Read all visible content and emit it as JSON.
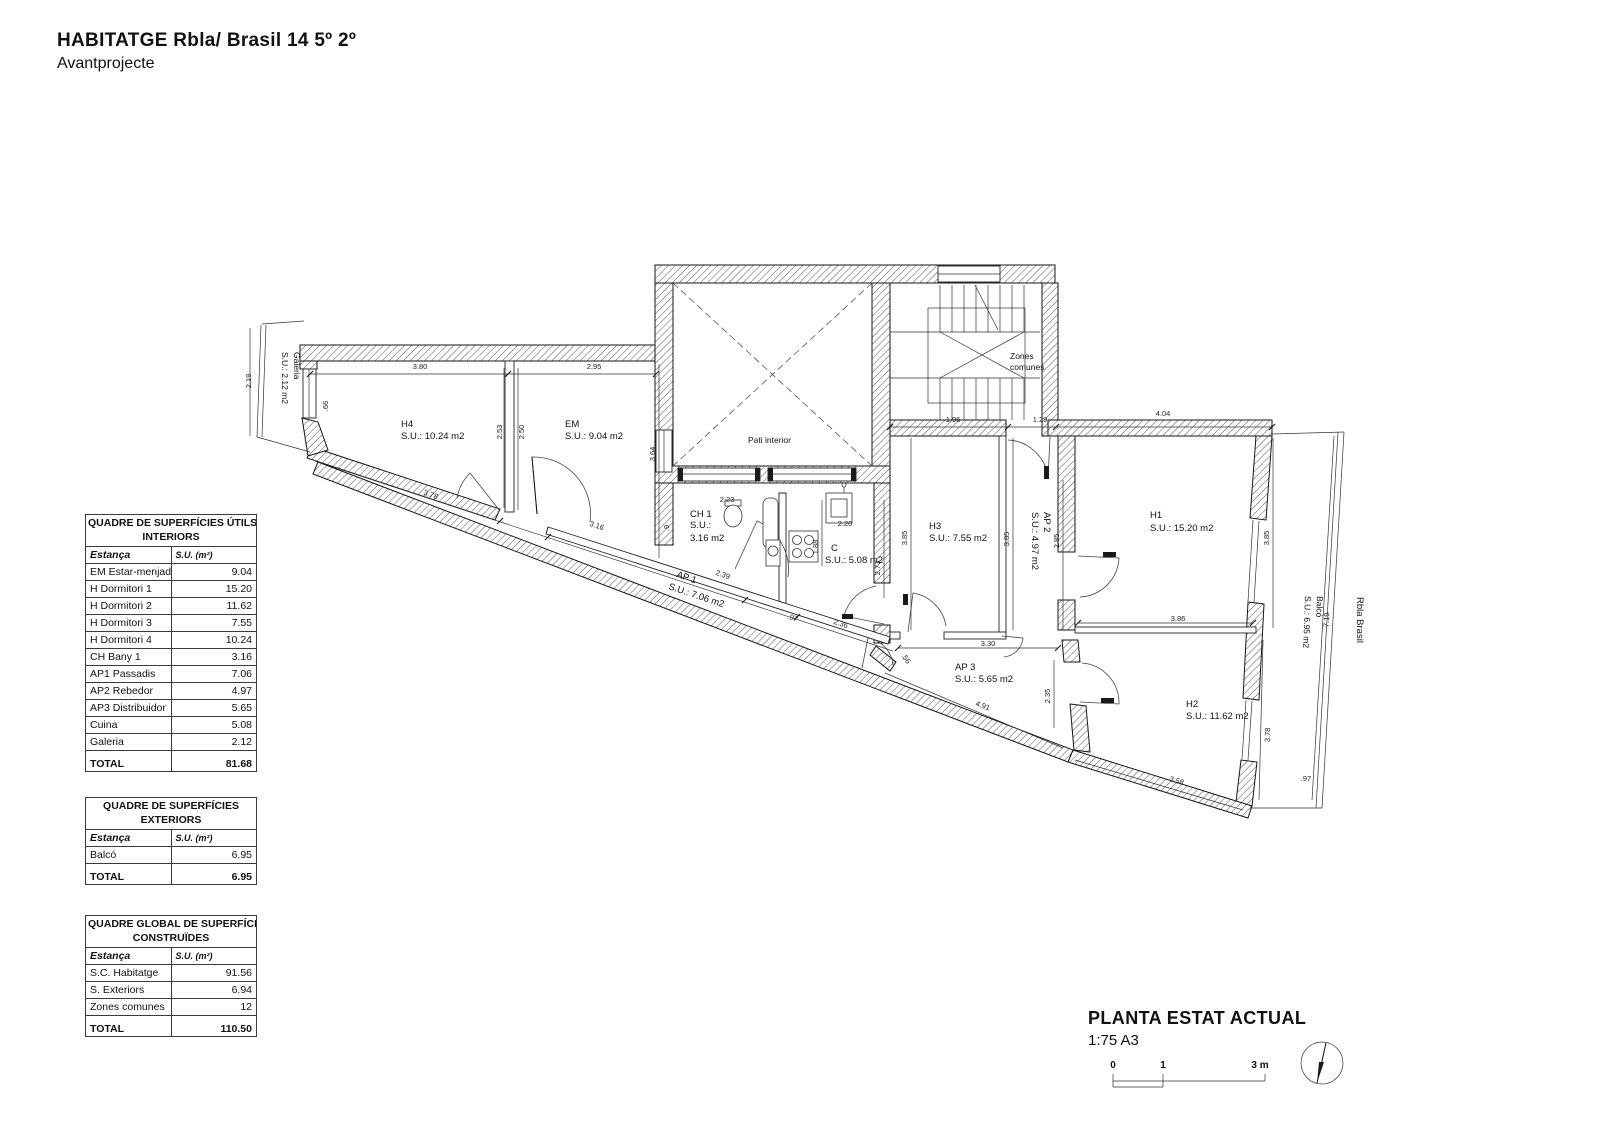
{
  "header": {
    "title": "HABITATGE Rbla/ Brasil 14 5º 2º",
    "subtitle": "Avantprojecte"
  },
  "tables": {
    "interiors": {
      "title1": "QUADRE DE SUPERFÍCIES ÚTILS",
      "title2": "INTERIORS",
      "col_room": "Estança",
      "col_area": "S.U. (m²)",
      "rows": [
        {
          "label": "EM Estar-menjador",
          "value": "9.04"
        },
        {
          "label": "H Dormitori 1",
          "value": "15.20"
        },
        {
          "label": "H Dormitori 2",
          "value": "11.62"
        },
        {
          "label": "H Dormitori 3",
          "value": "7.55"
        },
        {
          "label": "H Dormitori 4",
          "value": "10.24"
        },
        {
          "label": "CH Bany 1",
          "value": "3.16"
        },
        {
          "label": "AP1 Passadis",
          "value": "7.06"
        },
        {
          "label": "AP2 Rebedor",
          "value": "4.97"
        },
        {
          "label": "AP3 Distribuidor",
          "value": "5.65"
        },
        {
          "label": "Cuina",
          "value": "5.08"
        },
        {
          "label": "Galeria",
          "value": "2.12"
        }
      ],
      "total_label": "TOTAL",
      "total_value": "81.68"
    },
    "exteriors": {
      "title1": "QUADRE DE SUPERFÍCIES",
      "title2": "EXTERIORS",
      "col_room": "Estança",
      "col_area": "S.U. (m²)",
      "rows": [
        {
          "label": "Balcó",
          "value": "6.95"
        }
      ],
      "total_label": "TOTAL",
      "total_value": "6.95"
    },
    "global": {
      "title1": "QUADRE GLOBAL DE SUPERFÍCIES",
      "title2": "CONSTRUÏDES",
      "col_room": "Estança",
      "col_area": "S.U. (m²)",
      "rows": [
        {
          "label": "S.C. Habitatge",
          "value": "91.56"
        },
        {
          "label": "S. Exteriors",
          "value": "6.94"
        },
        {
          "label": "Zones comunes",
          "value": "12"
        }
      ],
      "total_label": "TOTAL",
      "total_value": "110.50"
    }
  },
  "plan": {
    "rooms": {
      "h4": {
        "name": "H4",
        "area": "S.U.: 10.24 m2"
      },
      "em": {
        "name": "EM",
        "area": "S.U.: 9.04 m2"
      },
      "ch1": {
        "name": "CH 1",
        "area1": "S.U.:",
        "area2": "3.16 m2"
      },
      "c": {
        "name": "C",
        "area": "S.U.: 5.08 m2"
      },
      "h3": {
        "name": "H3",
        "area": "S.U.: 7.55 m2"
      },
      "ap2": {
        "name": "AP 2",
        "area": "S.U.: 4.97 m2"
      },
      "h1": {
        "name": "H1",
        "area": "S.U.: 15.20 m2"
      },
      "ap1": {
        "name": "AP 1",
        "area": "S.U.: 7.06 m2"
      },
      "ap3": {
        "name": "AP 3",
        "area": "S.U.: 5.65 m2"
      },
      "h2": {
        "name": "H2",
        "area": "S.U.: 11.62 m2"
      },
      "pati": {
        "name": "Pati interior"
      },
      "zones": {
        "name1": "Zones",
        "name2": "comunes"
      },
      "galeria": {
        "name": "Galeria",
        "area": "S.U.: 2.12 m2"
      },
      "balco": {
        "name": "Balcó",
        "area": "S.U.: 6.95 m2"
      },
      "street": {
        "name": "Rbla Brasil"
      }
    },
    "dims": [
      "2.19",
      ".66",
      "3.80",
      "2.95",
      "2.53",
      "2.50",
      "3.78",
      "3.16",
      "3.64",
      "2.23",
      ".9",
      "2.39",
      "2.20",
      "1.88",
      "2.73",
      "2.36",
      ".97",
      "3.85",
      "3.85",
      "2.85",
      "1.96",
      "1.29",
      "4.04",
      "3.85",
      "3.30",
      "3.86",
      "2.35",
      "4.91",
      ".56",
      "3.78",
      "3.58",
      "7.19",
      ".97"
    ]
  },
  "titleblock": {
    "title": "PLANTA ESTAT ACTUAL",
    "scale": "1:75 A3",
    "bar0": "0",
    "bar1": "1",
    "bar3": "3 m"
  }
}
